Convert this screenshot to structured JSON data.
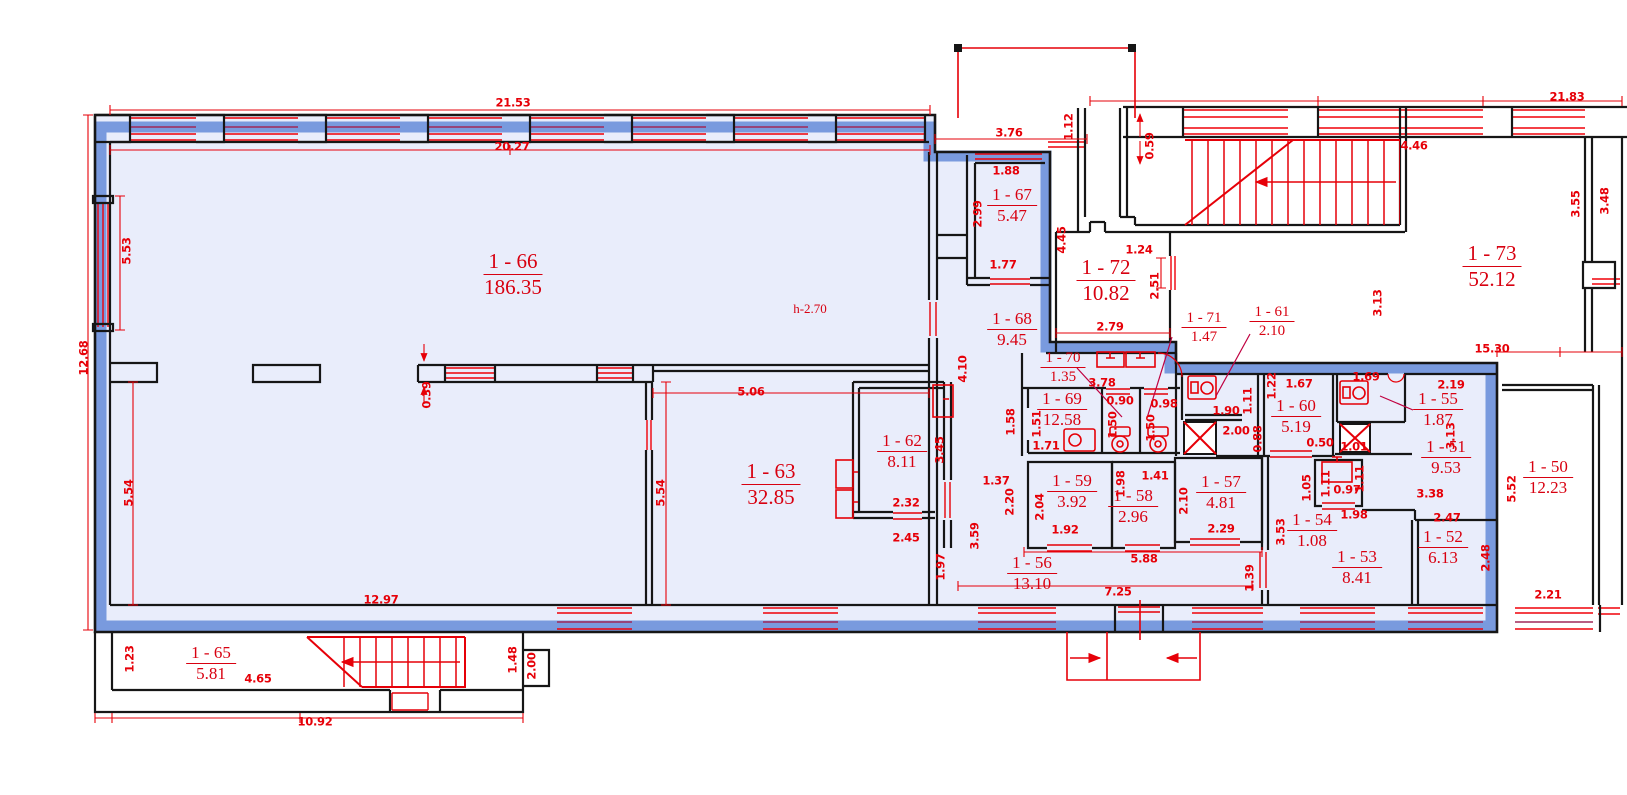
{
  "plan": {
    "title": "apartment-floor-plan",
    "ceiling_note": "h-2.70",
    "colors": {
      "wall": "#161616",
      "annotation_red": "#e60008",
      "room_fill": "#e9edfb",
      "selection_blue": "#5d85d7",
      "background": "#ffffff"
    },
    "rooms": [
      {
        "id": "1 - 66",
        "area": "186.35",
        "x": 513,
        "y": 250,
        "s": "lg"
      },
      {
        "id": "1 - 67",
        "area": "5.47",
        "x": 1012,
        "y": 186,
        "s": "md"
      },
      {
        "id": "1 - 68",
        "area": "9.45",
        "x": 1012,
        "y": 310,
        "s": "md"
      },
      {
        "id": "1 - 72",
        "area": "10.82",
        "x": 1106,
        "y": 256,
        "s": "lg"
      },
      {
        "id": "1 - 71",
        "area": "1.47",
        "x": 1204,
        "y": 310,
        "s": "sm"
      },
      {
        "id": "1 - 61",
        "area": "2.10",
        "x": 1272,
        "y": 304,
        "s": "sm"
      },
      {
        "id": "1 - 73",
        "area": "52.12",
        "x": 1492,
        "y": 242,
        "s": "lg"
      },
      {
        "id": "1 - 70",
        "area": "1.35",
        "x": 1063,
        "y": 350,
        "s": "sm"
      },
      {
        "id": "1 - 69",
        "area": "12.58",
        "x": 1062,
        "y": 390,
        "s": "md"
      },
      {
        "id": "1 - 60",
        "area": "5.19",
        "x": 1296,
        "y": 397,
        "s": "md"
      },
      {
        "id": "1 - 55",
        "area": "1.87",
        "x": 1438,
        "y": 390,
        "s": "md"
      },
      {
        "id": "1 - 51",
        "area": "9.53",
        "x": 1446,
        "y": 438,
        "s": "md"
      },
      {
        "id": "1 - 50",
        "area": "12.23",
        "x": 1548,
        "y": 458,
        "s": "md"
      },
      {
        "id": "1 - 62",
        "area": "8.11",
        "x": 902,
        "y": 432,
        "s": "md"
      },
      {
        "id": "1 - 63",
        "area": "32.85",
        "x": 771,
        "y": 460,
        "s": "lg"
      },
      {
        "id": "1 - 59",
        "area": "3.92",
        "x": 1072,
        "y": 472,
        "s": "md"
      },
      {
        "id": "1 - 58",
        "area": "2.96",
        "x": 1133,
        "y": 487,
        "s": "md"
      },
      {
        "id": "1 - 57",
        "area": "4.81",
        "x": 1221,
        "y": 473,
        "s": "md"
      },
      {
        "id": "1 - 54",
        "area": "1.08",
        "x": 1312,
        "y": 511,
        "s": "md"
      },
      {
        "id": "1 - 53",
        "area": "8.41",
        "x": 1357,
        "y": 548,
        "s": "md"
      },
      {
        "id": "1 - 52",
        "area": "6.13",
        "x": 1443,
        "y": 528,
        "s": "md"
      },
      {
        "id": "1 - 56",
        "area": "13.10",
        "x": 1032,
        "y": 554,
        "s": "md"
      },
      {
        "id": "1 - 65",
        "area": "5.81",
        "x": 211,
        "y": 644,
        "s": "md"
      }
    ],
    "dims": [
      {
        "t": "21.53",
        "x": 513,
        "y": 103
      },
      {
        "t": "20.27",
        "x": 512,
        "y": 147
      },
      {
        "t": "3.76",
        "x": 1009,
        "y": 133
      },
      {
        "t": "1.12",
        "x": 1069,
        "y": 127,
        "r": 1
      },
      {
        "t": "0.59",
        "x": 1150,
        "y": 146,
        "r": 1
      },
      {
        "t": "1.88",
        "x": 1006,
        "y": 171
      },
      {
        "t": "2.99",
        "x": 978,
        "y": 214,
        "r": 1
      },
      {
        "t": "1.77",
        "x": 1003,
        "y": 265
      },
      {
        "t": "4.45",
        "x": 1062,
        "y": 240,
        "r": 1
      },
      {
        "t": "1.24",
        "x": 1139,
        "y": 250
      },
      {
        "t": "2.51",
        "x": 1155,
        "y": 286,
        "r": 1
      },
      {
        "t": "2.79",
        "x": 1110,
        "y": 327
      },
      {
        "t": "21.83",
        "x": 1567,
        "y": 97
      },
      {
        "t": "4.46",
        "x": 1414,
        "y": 146
      },
      {
        "t": "3.55",
        "x": 1576,
        "y": 204,
        "r": 1
      },
      {
        "t": "3.48",
        "x": 1605,
        "y": 201,
        "r": 1
      },
      {
        "t": "3.13",
        "x": 1378,
        "y": 303,
        "r": 1
      },
      {
        "t": "15.30",
        "x": 1492,
        "y": 349
      },
      {
        "t": "5.53",
        "x": 127,
        "y": 251,
        "r": 1
      },
      {
        "t": "12.68",
        "x": 84,
        "y": 358,
        "r": 1
      },
      {
        "t": "4.10",
        "x": 963,
        "y": 369,
        "r": 1
      },
      {
        "t": "3.78",
        "x": 1102,
        "y": 383
      },
      {
        "t": "0.90",
        "x": 1120,
        "y": 401
      },
      {
        "t": "0.98",
        "x": 1164,
        "y": 404
      },
      {
        "t": "1.50",
        "x": 1113,
        "y": 425,
        "r": 1
      },
      {
        "t": "1.50",
        "x": 1151,
        "y": 428,
        "r": 1
      },
      {
        "t": "1.58",
        "x": 1011,
        "y": 422,
        "r": 1
      },
      {
        "t": "1.51",
        "x": 1037,
        "y": 424,
        "r": 1
      },
      {
        "t": "1.71",
        "x": 1046,
        "y": 446
      },
      {
        "t": "1.90",
        "x": 1226,
        "y": 411
      },
      {
        "t": "1.11",
        "x": 1248,
        "y": 401,
        "r": 1
      },
      {
        "t": "2.00",
        "x": 1236,
        "y": 431
      },
      {
        "t": "0.88",
        "x": 1258,
        "y": 439,
        "r": 1
      },
      {
        "t": "1.22",
        "x": 1272,
        "y": 386,
        "r": 1
      },
      {
        "t": "1.67",
        "x": 1299,
        "y": 384
      },
      {
        "t": "1.69",
        "x": 1366,
        "y": 377
      },
      {
        "t": "0.50",
        "x": 1320,
        "y": 443
      },
      {
        "t": "2.19",
        "x": 1451,
        "y": 385
      },
      {
        "t": "1.01",
        "x": 1354,
        "y": 447
      },
      {
        "t": "3.13",
        "x": 1451,
        "y": 436,
        "r": 1
      },
      {
        "t": "5.06",
        "x": 751,
        "y": 392
      },
      {
        "t": "0.39",
        "x": 427,
        "y": 395,
        "r": 1
      },
      {
        "t": "5.54",
        "x": 129,
        "y": 493,
        "r": 1
      },
      {
        "t": "5.54",
        "x": 661,
        "y": 493,
        "r": 1
      },
      {
        "t": "3.45",
        "x": 940,
        "y": 450,
        "r": 1
      },
      {
        "t": "2.32",
        "x": 906,
        "y": 503
      },
      {
        "t": "2.45",
        "x": 906,
        "y": 538
      },
      {
        "t": "1.37",
        "x": 996,
        "y": 481
      },
      {
        "t": "2.20",
        "x": 1010,
        "y": 502,
        "r": 1
      },
      {
        "t": "2.04",
        "x": 1040,
        "y": 507,
        "r": 1
      },
      {
        "t": "1.92",
        "x": 1065,
        "y": 530
      },
      {
        "t": "1.98",
        "x": 1121,
        "y": 484,
        "r": 1
      },
      {
        "t": "1.41",
        "x": 1155,
        "y": 476
      },
      {
        "t": "2.10",
        "x": 1184,
        "y": 501,
        "r": 1
      },
      {
        "t": "2.29",
        "x": 1221,
        "y": 529
      },
      {
        "t": "3.59",
        "x": 975,
        "y": 536,
        "r": 1
      },
      {
        "t": "1.97",
        "x": 941,
        "y": 567,
        "r": 1
      },
      {
        "t": "12.97",
        "x": 381,
        "y": 600
      },
      {
        "t": "5.88",
        "x": 1144,
        "y": 559
      },
      {
        "t": "7.25",
        "x": 1118,
        "y": 592
      },
      {
        "t": "1.39",
        "x": 1250,
        "y": 578,
        "r": 1
      },
      {
        "t": "3.53",
        "x": 1281,
        "y": 532,
        "r": 1
      },
      {
        "t": "1.05",
        "x": 1307,
        "y": 488,
        "r": 1
      },
      {
        "t": "1.11",
        "x": 1326,
        "y": 484,
        "r": 1
      },
      {
        "t": "0.97",
        "x": 1347,
        "y": 490
      },
      {
        "t": "1.98",
        "x": 1354,
        "y": 515
      },
      {
        "t": "1.11",
        "x": 1360,
        "y": 479,
        "r": 1
      },
      {
        "t": "3.38",
        "x": 1430,
        "y": 494
      },
      {
        "t": "2.47",
        "x": 1447,
        "y": 518
      },
      {
        "t": "2.48",
        "x": 1486,
        "y": 558,
        "r": 1
      },
      {
        "t": "5.52",
        "x": 1512,
        "y": 489,
        "r": 1
      },
      {
        "t": "2.21",
        "x": 1548,
        "y": 595
      },
      {
        "t": "1.23",
        "x": 130,
        "y": 659,
        "r": 1
      },
      {
        "t": "4.65",
        "x": 258,
        "y": 679
      },
      {
        "t": "10.92",
        "x": 315,
        "y": 722
      },
      {
        "t": "1.48",
        "x": 513,
        "y": 660,
        "r": 1
      },
      {
        "t": "2.00",
        "x": 532,
        "y": 666,
        "r": 1
      }
    ],
    "note": {
      "text": "h-2.70",
      "x": 810,
      "y": 309
    }
  }
}
